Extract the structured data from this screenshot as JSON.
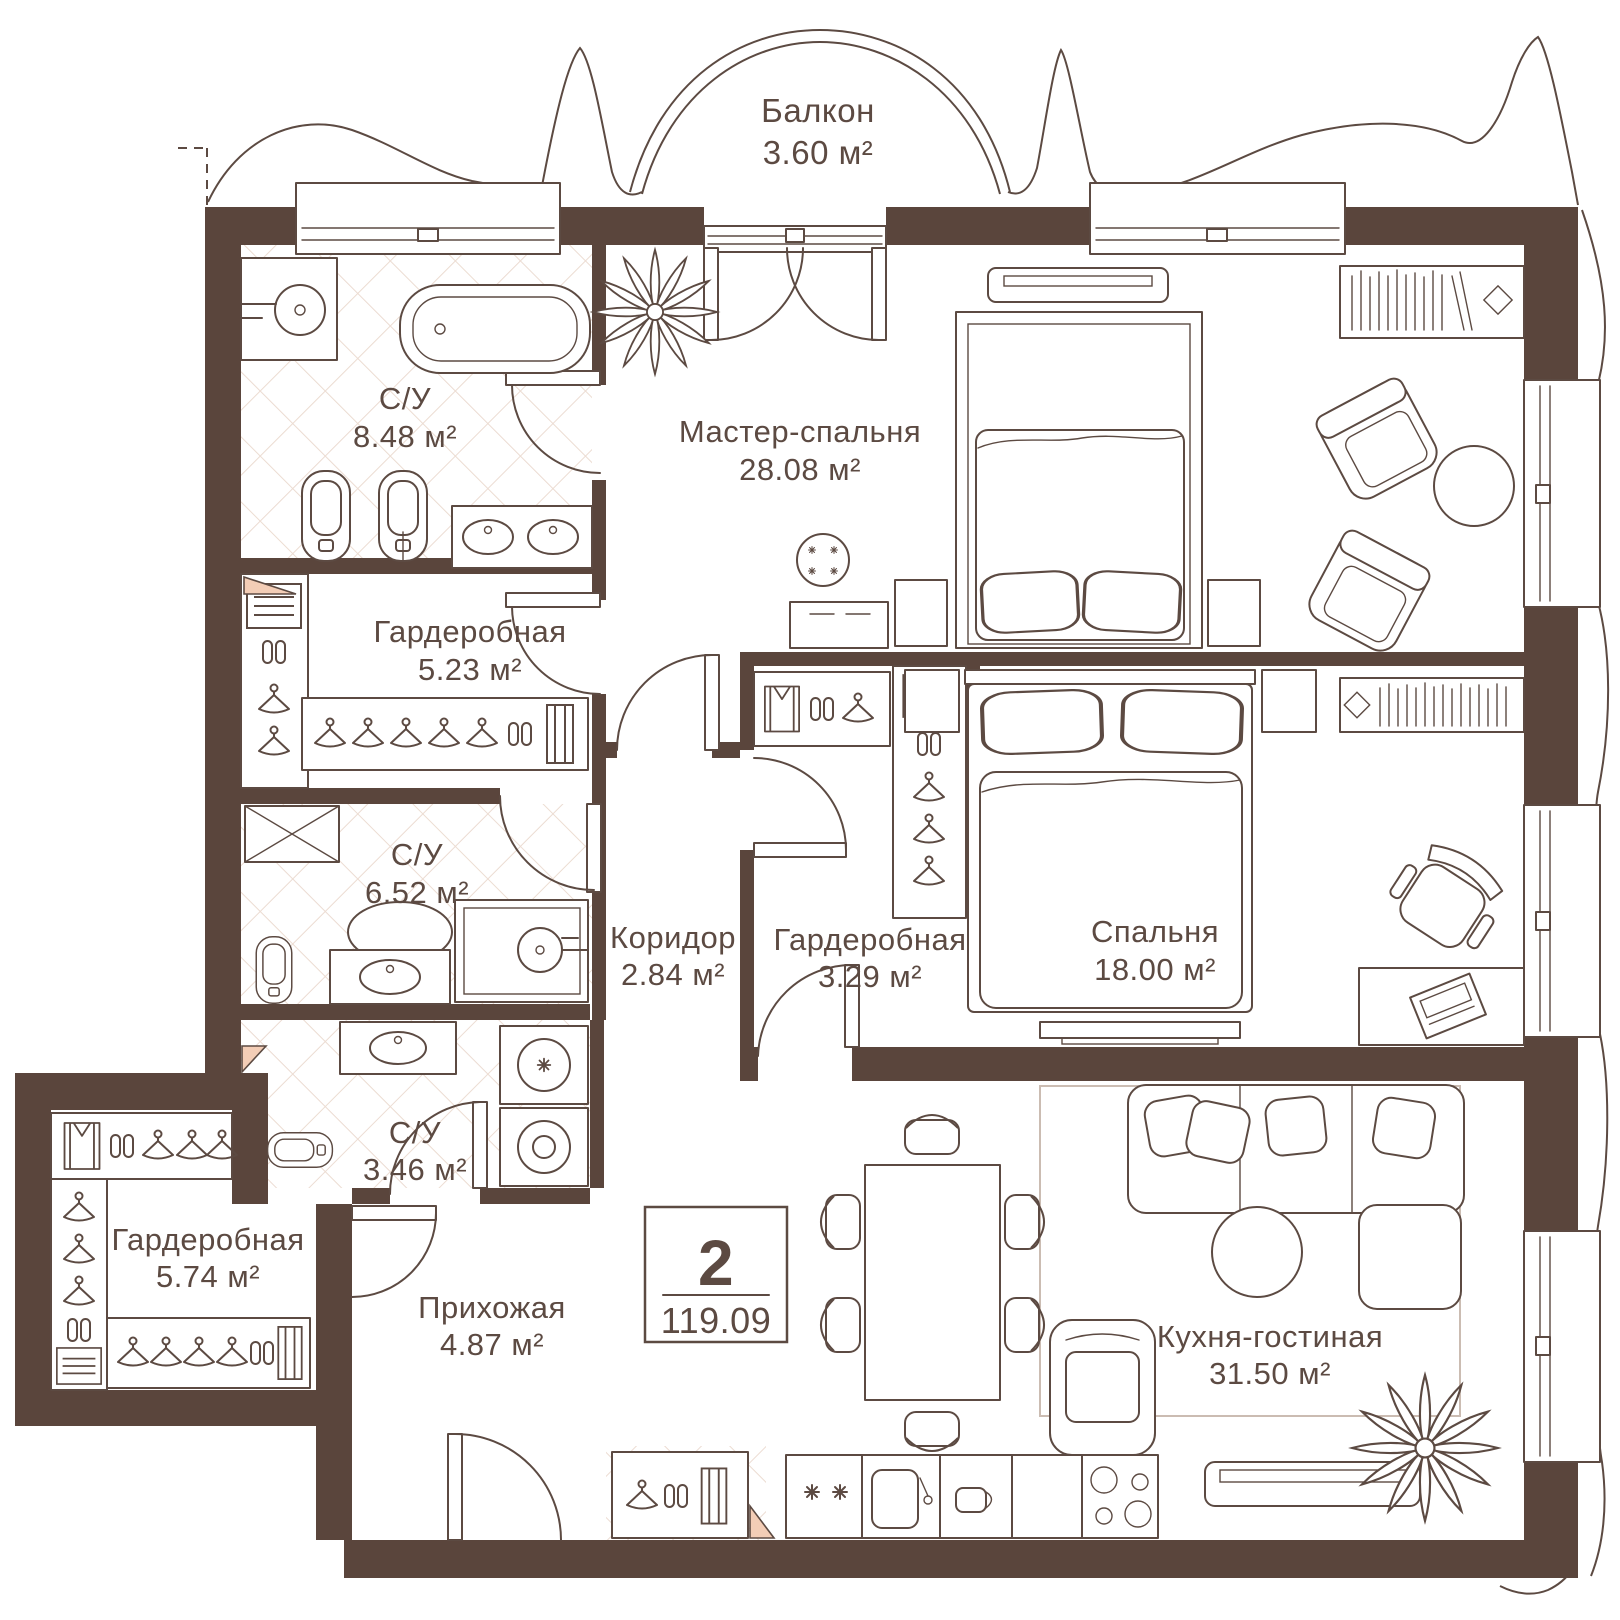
{
  "colors": {
    "wall": "#5a453c",
    "line": "#5c4a42",
    "tile": "#ecdcd2",
    "accent": "#f3cdb6",
    "background": "#ffffff"
  },
  "badge": {
    "rooms_count": "2",
    "total_area": "119.09"
  },
  "rooms": [
    {
      "id": "balcony",
      "name": "Балкон",
      "area": "3.60 м²"
    },
    {
      "id": "bath-top",
      "name": "С/У",
      "area": "8.48 м²"
    },
    {
      "id": "master-bedroom",
      "name": "Мастер-спальня",
      "area": "28.08 м²"
    },
    {
      "id": "wardrobe-top",
      "name": "Гардеробная",
      "area": "5.23 м²"
    },
    {
      "id": "bath-middle",
      "name": "С/У",
      "area": "6.52 м²"
    },
    {
      "id": "corridor",
      "name": "Коридор",
      "area": "2.84 м²"
    },
    {
      "id": "wardrobe-middle",
      "name": "Гардеробная",
      "area": "3.29 м²"
    },
    {
      "id": "bedroom",
      "name": "Спальня",
      "area": "18.00 м²"
    },
    {
      "id": "bath-small",
      "name": "С/У",
      "area": "3.46 м²"
    },
    {
      "id": "wardrobe-bottom",
      "name": "Гардеробная",
      "area": "5.74 м²"
    },
    {
      "id": "hallway",
      "name": "Прихожая",
      "area": "4.87 м²"
    },
    {
      "id": "kitchen-living",
      "name": "Кухня-гостиная",
      "area": "31.50 м²"
    }
  ]
}
